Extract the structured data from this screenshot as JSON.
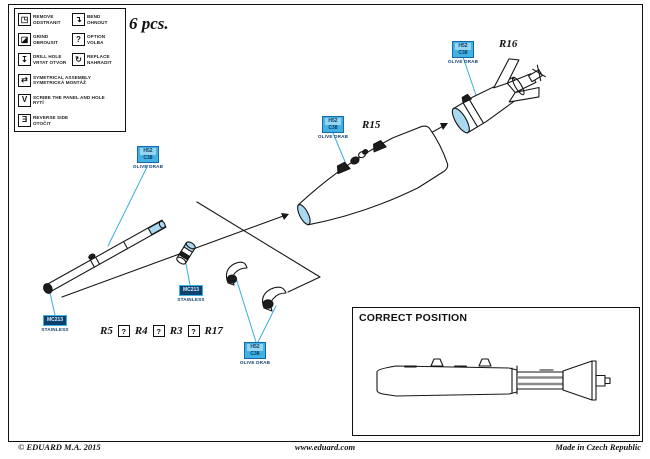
{
  "header": {
    "pcs": "6 pcs."
  },
  "legend": {
    "items": [
      {
        "icon": "remove-icon",
        "glyph": "◳",
        "en": "REMOVE",
        "cz": "ODSTRANIT"
      },
      {
        "icon": "bend-icon",
        "glyph": "↴",
        "en": "BEND",
        "cz": "OHNOUT"
      },
      {
        "icon": "grind-icon",
        "glyph": "◪",
        "en": "GRIND",
        "cz": "OBROUSIT"
      },
      {
        "icon": "option-icon",
        "glyph": "?",
        "en": "OPTION",
        "cz": "VOLBA"
      },
      {
        "icon": "drill-hole-icon",
        "glyph": "↧",
        "en": "DRILL HOLE",
        "cz": "VRTAT OTVOR"
      },
      {
        "icon": "replace-icon",
        "glyph": "↻",
        "en": "REPLACE",
        "cz": "NAHRADIT"
      },
      {
        "icon": "symmetrical-assembly-icon",
        "glyph": "⇄",
        "en": "SYMETRICAL ASSEMBLY",
        "cz": "SYMETRICKÁ MONTÁŽ"
      },
      {
        "icon": "scribe-icon",
        "glyph": "V",
        "en": "SCRIBE THE PANEL AND HOLE",
        "cz": "RYTÍ"
      },
      {
        "icon": "reverse-side-icon",
        "glyph": "Ǝ",
        "en": "REVERSE SIDE",
        "cz": "OTOČIT"
      }
    ]
  },
  "paint": {
    "olive": {
      "code_line1": "H52",
      "code_line2": "C38",
      "name": "OLIVE DRAB"
    },
    "stainless": {
      "code": "MC213",
      "name": "STAINLESS"
    }
  },
  "labels": {
    "r16": "R16",
    "r15": "R15",
    "r5": "R5",
    "r4": "R4",
    "r3": "R3",
    "r17": "R17",
    "option_mark": "?"
  },
  "correct_position": {
    "title": "CORRECT POSITION"
  },
  "footer": {
    "copyright": "© EDUARD  M.A.  2015",
    "website": "www.eduard.com",
    "made_in": "Made in Czech Republic"
  },
  "colors": {
    "accent_cyan": "#38aede",
    "part_fill": "#a9d9f1",
    "callout_fill": "#41b2e2",
    "steel_fill": "#113f6e",
    "label_navy": "#123f6e",
    "line_art": "#161616"
  }
}
